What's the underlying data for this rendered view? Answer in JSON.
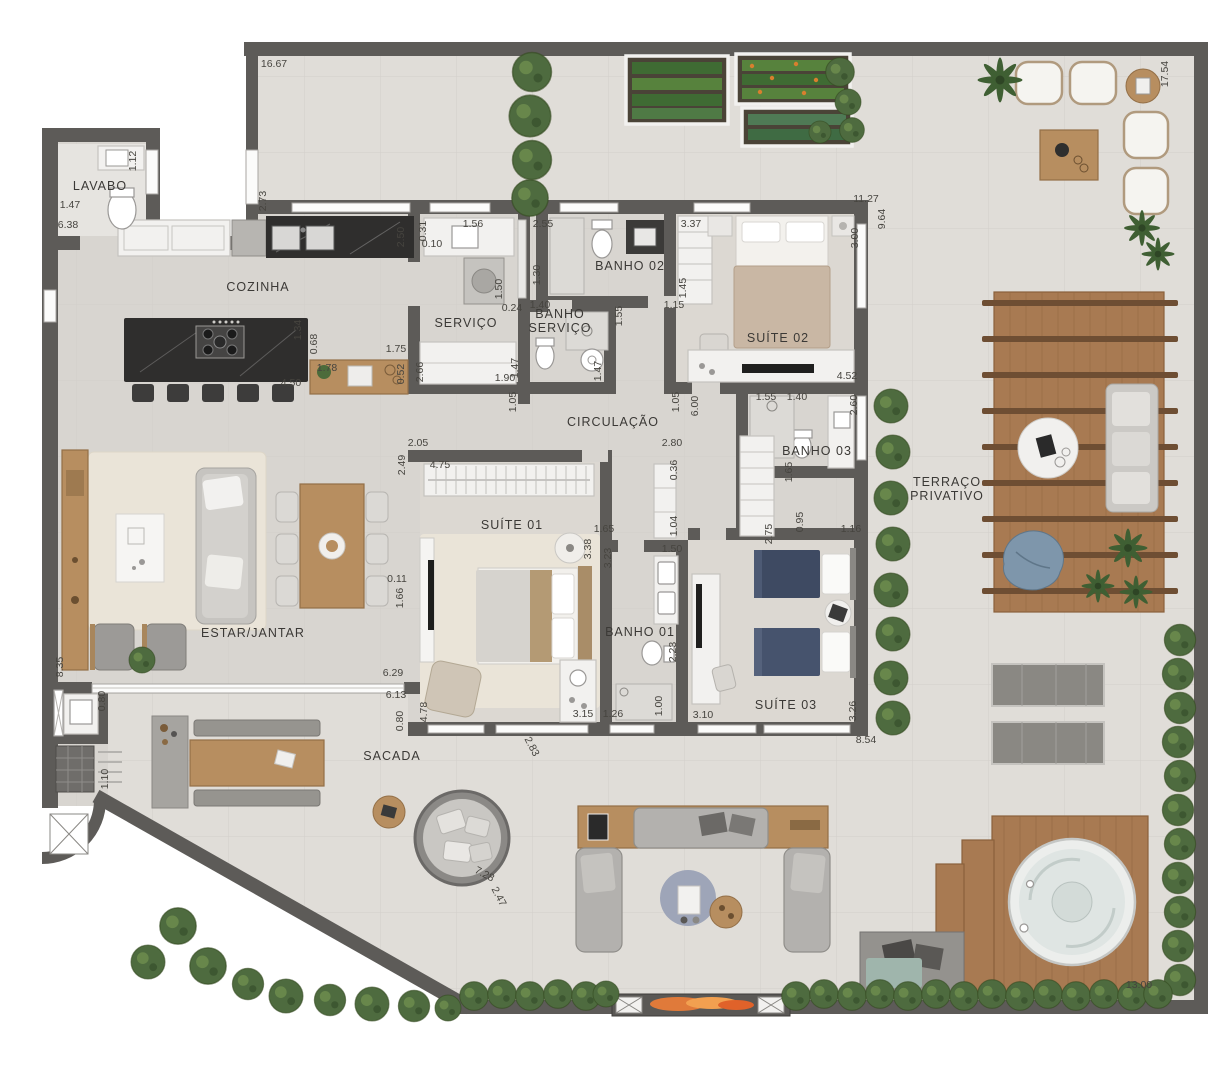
{
  "plan": {
    "type": "apartment-floor-plan",
    "language": "pt-BR",
    "rooms": [
      {
        "id": "lavabo",
        "label": "LAVABO",
        "x": 100,
        "y": 190
      },
      {
        "id": "cozinha",
        "label": "COZINHA",
        "x": 258,
        "y": 291
      },
      {
        "id": "servico",
        "label": "SERVIÇO",
        "x": 466,
        "y": 327
      },
      {
        "id": "banho-servico",
        "label": "BANHO\nSERVIÇO",
        "x": 560,
        "y": 318
      },
      {
        "id": "banho-02",
        "label": "BANHO 02",
        "x": 630,
        "y": 270
      },
      {
        "id": "suite-02",
        "label": "SUÍTE 02",
        "x": 778,
        "y": 342
      },
      {
        "id": "circulacao",
        "label": "CIRCULAÇÃO",
        "x": 613,
        "y": 426
      },
      {
        "id": "banho-03",
        "label": "BANHO 03",
        "x": 817,
        "y": 455
      },
      {
        "id": "suite-01",
        "label": "SUÍTE 01",
        "x": 512,
        "y": 529
      },
      {
        "id": "banho-01",
        "label": "BANHO 01",
        "x": 640,
        "y": 636
      },
      {
        "id": "suite-03",
        "label": "SUÍTE 03",
        "x": 786,
        "y": 709
      },
      {
        "id": "terraco-privativo",
        "label": "TERRAÇO\nPRIVATIVO",
        "x": 947,
        "y": 486
      },
      {
        "id": "estar-jantar",
        "label": "ESTAR/JANTAR",
        "x": 253,
        "y": 637
      },
      {
        "id": "sacada",
        "label": "SACADA",
        "x": 392,
        "y": 760
      }
    ],
    "dims": [
      {
        "v": "16.67",
        "x": 274,
        "y": 67,
        "r": 0
      },
      {
        "v": "17.54",
        "x": 1168,
        "y": 74,
        "r": -90
      },
      {
        "v": "2.73",
        "x": 266,
        "y": 201,
        "r": -90
      },
      {
        "v": "1.12",
        "x": 136,
        "y": 161,
        "r": -90
      },
      {
        "v": "1.47",
        "x": 70,
        "y": 208,
        "r": 0
      },
      {
        "v": "6.38",
        "x": 68,
        "y": 228,
        "r": 0
      },
      {
        "v": "2.50",
        "x": 404,
        "y": 237,
        "r": -90
      },
      {
        "v": "0.31",
        "x": 426,
        "y": 231,
        "r": -90
      },
      {
        "v": "0.10",
        "x": 432,
        "y": 247,
        "r": 0
      },
      {
        "v": "1.56",
        "x": 473,
        "y": 227,
        "r": 0
      },
      {
        "v": "2.55",
        "x": 543,
        "y": 227,
        "r": 0
      },
      {
        "v": "3.37",
        "x": 691,
        "y": 227,
        "r": 0
      },
      {
        "v": "1.30",
        "x": 540,
        "y": 275,
        "r": -90
      },
      {
        "v": "1.50",
        "x": 502,
        "y": 289,
        "r": -90
      },
      {
        "v": "1.45",
        "x": 686,
        "y": 288,
        "r": -90
      },
      {
        "v": "0.24",
        "x": 512,
        "y": 311,
        "r": 0
      },
      {
        "v": "1.40",
        "x": 540,
        "y": 308,
        "r": 0
      },
      {
        "v": "1.55",
        "x": 622,
        "y": 316,
        "r": -90
      },
      {
        "v": "1.15",
        "x": 674,
        "y": 308,
        "r": 0
      },
      {
        "v": "11.27",
        "x": 866,
        "y": 202,
        "r": 0
      },
      {
        "v": "9.64",
        "x": 885,
        "y": 219,
        "r": -90
      },
      {
        "v": "3.00",
        "x": 858,
        "y": 238,
        "r": -90
      },
      {
        "v": "1.34",
        "x": 301,
        "y": 330,
        "r": -90
      },
      {
        "v": "0.68",
        "x": 317,
        "y": 344,
        "r": -90
      },
      {
        "v": "1.78",
        "x": 327,
        "y": 371,
        "r": 0
      },
      {
        "v": "1.75",
        "x": 396,
        "y": 352,
        "r": 0
      },
      {
        "v": "4.50",
        "x": 291,
        "y": 386,
        "r": 0
      },
      {
        "v": "0.52",
        "x": 404,
        "y": 374,
        "r": -90
      },
      {
        "v": "2.66",
        "x": 423,
        "y": 372,
        "r": -90
      },
      {
        "v": "1.47",
        "x": 518,
        "y": 368,
        "r": -90
      },
      {
        "v": "1.90",
        "x": 505,
        "y": 381,
        "r": 0
      },
      {
        "v": "1.47",
        "x": 601,
        "y": 371,
        "r": -90
      },
      {
        "v": "4.52",
        "x": 847,
        "y": 379,
        "r": 0
      },
      {
        "v": "1.05",
        "x": 516,
        "y": 402,
        "r": -90
      },
      {
        "v": "1.05",
        "x": 679,
        "y": 402,
        "r": -90
      },
      {
        "v": "6.00",
        "x": 698,
        "y": 406,
        "r": -90
      },
      {
        "v": "1.55",
        "x": 766,
        "y": 400,
        "r": 0
      },
      {
        "v": "1.40",
        "x": 797,
        "y": 400,
        "r": 0
      },
      {
        "v": "2.60",
        "x": 857,
        "y": 405,
        "r": -90
      },
      {
        "v": "2.05",
        "x": 418,
        "y": 446,
        "r": 0
      },
      {
        "v": "2.80",
        "x": 672,
        "y": 446,
        "r": 0
      },
      {
        "v": "2.49",
        "x": 405,
        "y": 465,
        "r": -90
      },
      {
        "v": "4.75",
        "x": 440,
        "y": 468,
        "r": 0
      },
      {
        "v": "0.36",
        "x": 677,
        "y": 470,
        "r": -90
      },
      {
        "v": "1.65",
        "x": 792,
        "y": 472,
        "r": -90
      },
      {
        "v": "0.95",
        "x": 803,
        "y": 522,
        "r": -90
      },
      {
        "v": "1.16",
        "x": 851,
        "y": 532,
        "r": 0
      },
      {
        "v": "2.75",
        "x": 772,
        "y": 534,
        "r": -90
      },
      {
        "v": "1.04",
        "x": 677,
        "y": 526,
        "r": -90
      },
      {
        "v": "1.65",
        "x": 604,
        "y": 532,
        "r": 0
      },
      {
        "v": "3.38",
        "x": 591,
        "y": 549,
        "r": -90
      },
      {
        "v": "3.23",
        "x": 611,
        "y": 558,
        "r": -90
      },
      {
        "v": "1.50",
        "x": 672,
        "y": 552,
        "r": 0
      },
      {
        "v": "0.11",
        "x": 397,
        "y": 582,
        "r": 0
      },
      {
        "v": "1.66",
        "x": 403,
        "y": 598,
        "r": -90
      },
      {
        "v": "8.35",
        "x": 63,
        "y": 667,
        "r": -90
      },
      {
        "v": "6.29",
        "x": 393,
        "y": 676,
        "r": 0
      },
      {
        "v": "6.13",
        "x": 396,
        "y": 698,
        "r": 0
      },
      {
        "v": "0.80",
        "x": 403,
        "y": 721,
        "r": -90
      },
      {
        "v": "4.78",
        "x": 427,
        "y": 712,
        "r": -90
      },
      {
        "v": "2.23",
        "x": 676,
        "y": 652,
        "r": -90
      },
      {
        "v": "1.00",
        "x": 662,
        "y": 706,
        "r": -90
      },
      {
        "v": "1.26",
        "x": 613,
        "y": 717,
        "r": 0
      },
      {
        "v": "3.15",
        "x": 583,
        "y": 717,
        "r": 0
      },
      {
        "v": "2.83",
        "x": 529,
        "y": 748,
        "r": 62
      },
      {
        "v": "3.10",
        "x": 703,
        "y": 718,
        "r": 0
      },
      {
        "v": "3.26",
        "x": 856,
        "y": 711,
        "r": -90
      },
      {
        "v": "8.54",
        "x": 866,
        "y": 743,
        "r": 0
      },
      {
        "v": "0.80",
        "x": 105,
        "y": 701,
        "r": -90
      },
      {
        "v": "1.10",
        "x": 108,
        "y": 779,
        "r": -90
      },
      {
        "v": "7.28",
        "x": 483,
        "y": 877,
        "r": 28
      },
      {
        "v": "2.47",
        "x": 496,
        "y": 898,
        "r": 62
      },
      {
        "v": "13.00",
        "x": 1139,
        "y": 988,
        "r": 0
      }
    ],
    "palette": {
      "wall": "#5d5b58",
      "floor_indoor": "#d8d5d0",
      "floor_outdoor": "#e0ddd8",
      "carpet": "#eae4d8",
      "wood": "#b78e60",
      "wood_dark": "#936f47",
      "deck": "#a87a52",
      "green": "#4e6b3f",
      "green_dark": "#33491f",
      "navy": "#3e4a62",
      "water": "#dfe5e3",
      "fire": "#e07a3a"
    }
  }
}
